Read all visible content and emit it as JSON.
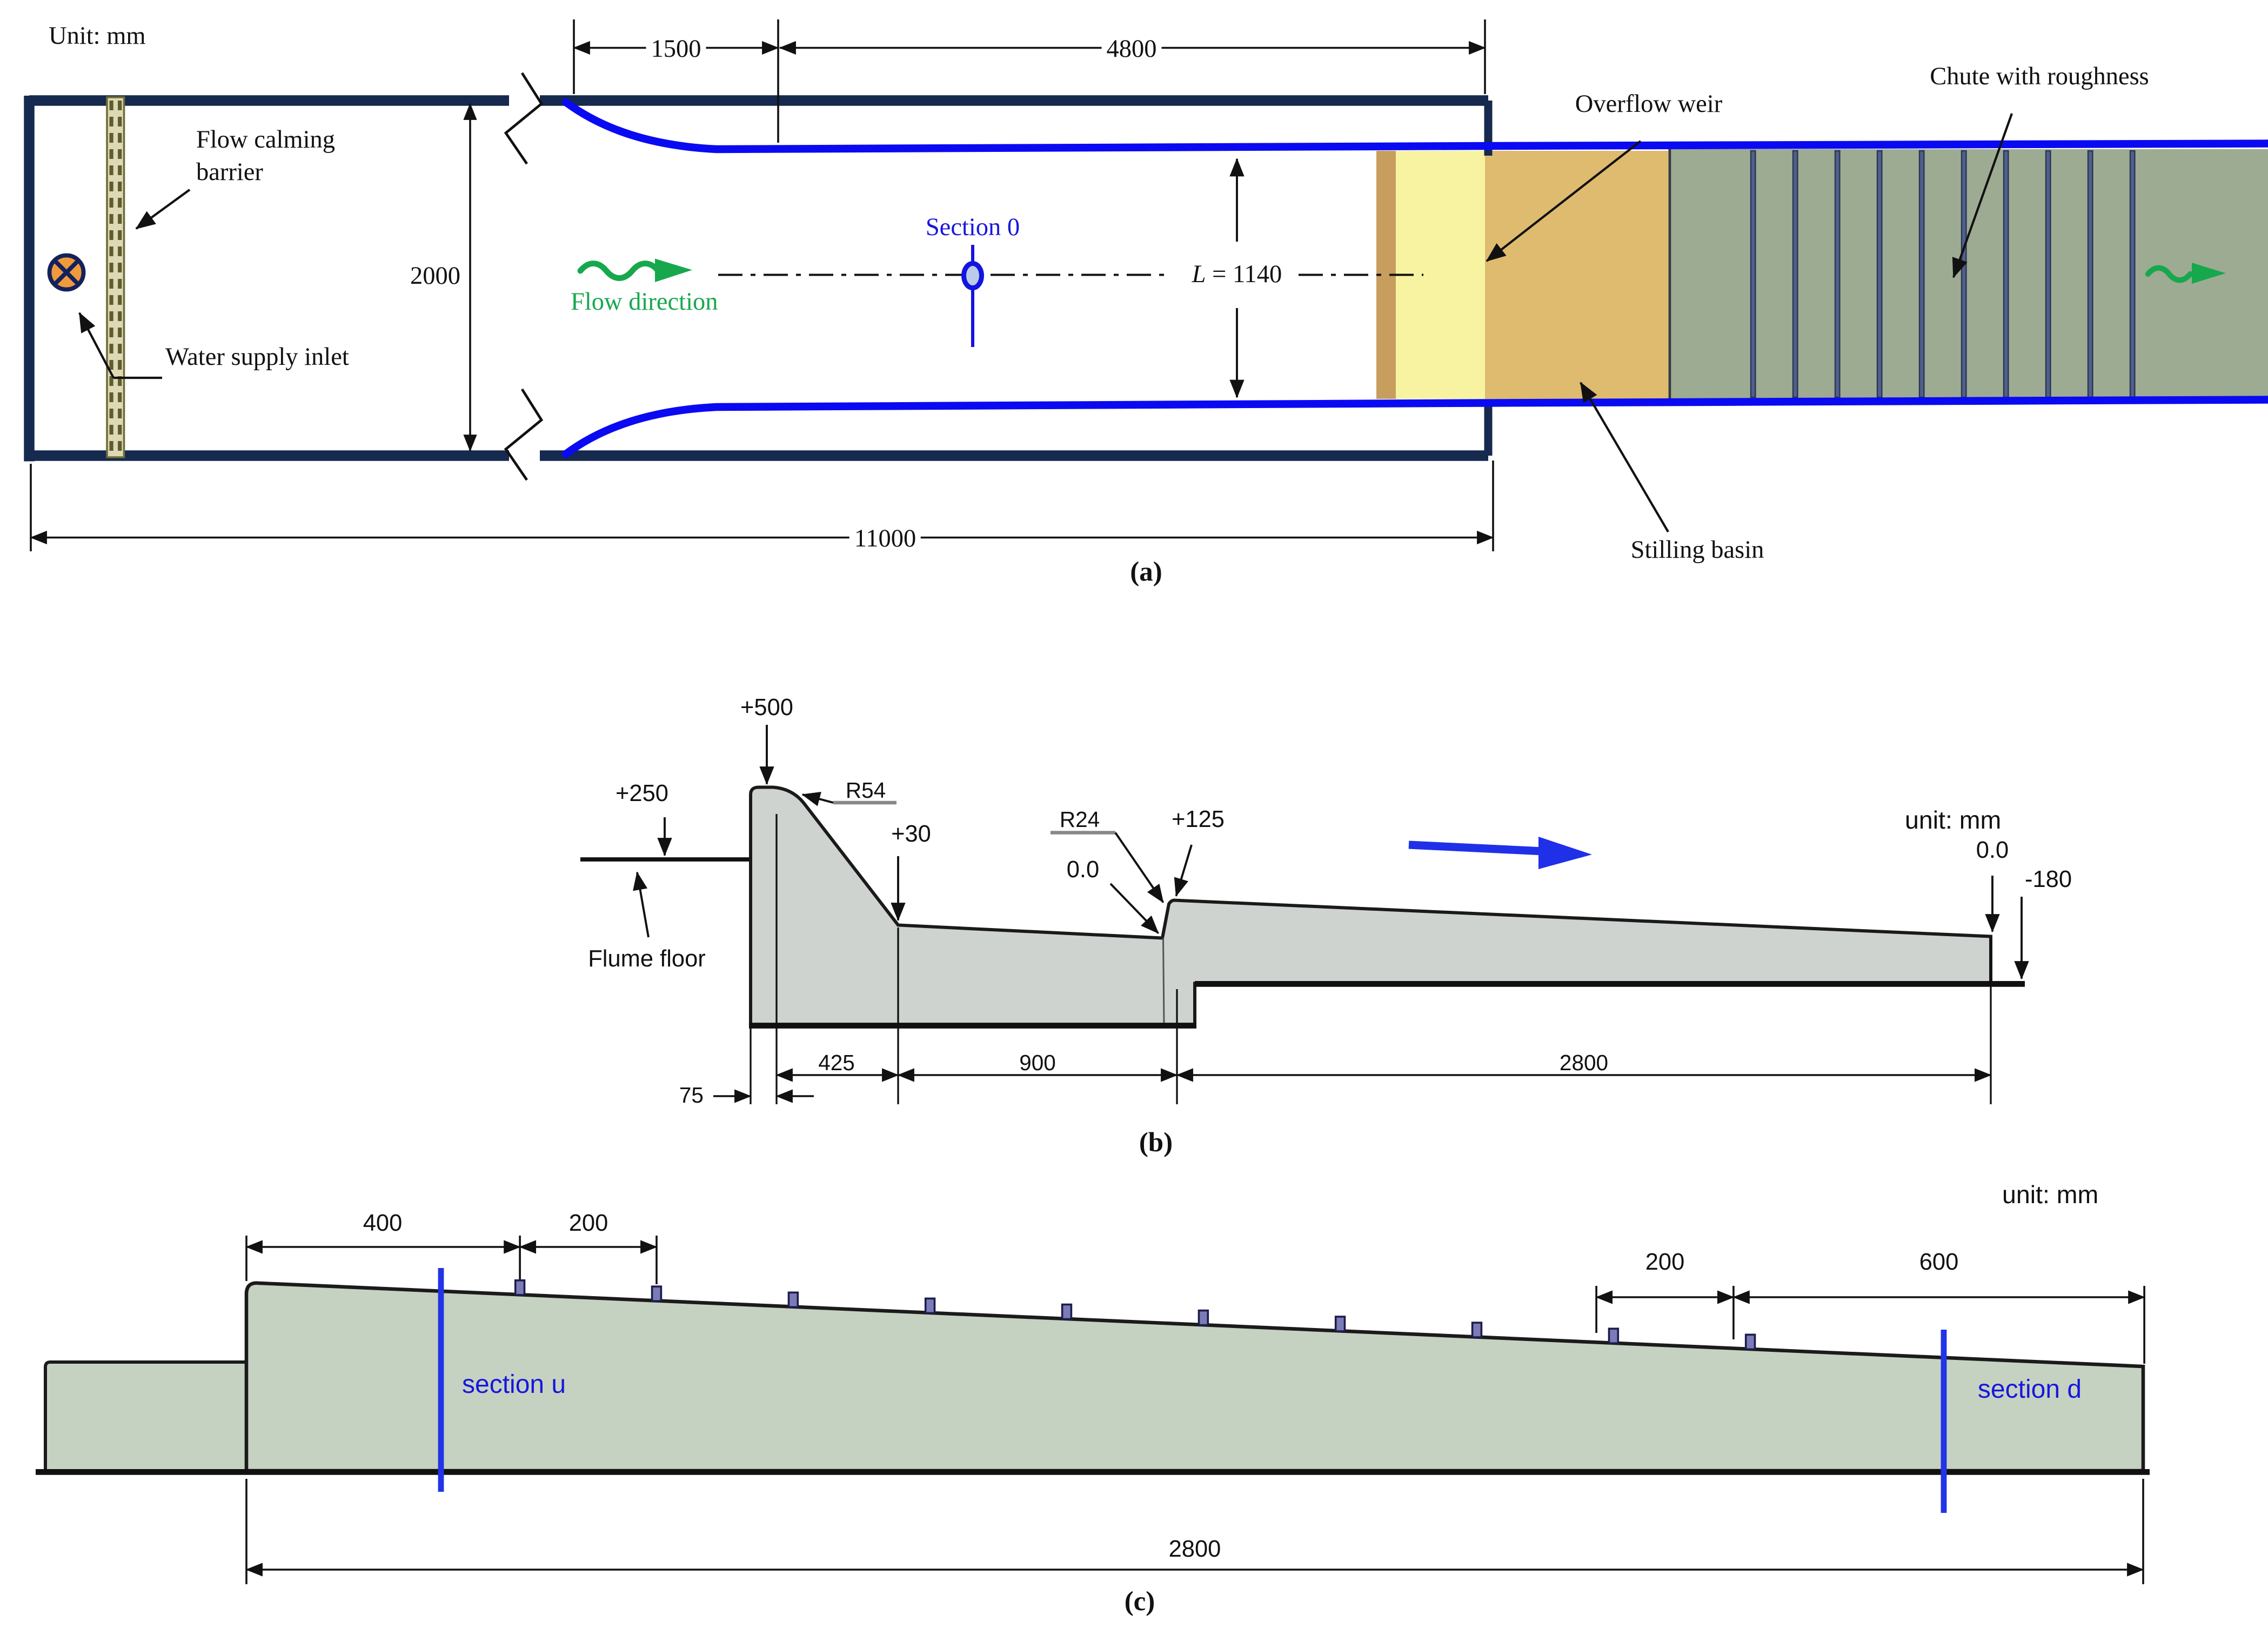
{
  "panel_a": {
    "unit_label": "Unit: mm",
    "labels": {
      "flow_calming_barrier": "Flow calming barrier",
      "water_supply_inlet": "Water supply inlet",
      "flow_direction": "Flow direction",
      "section_0": "Section 0",
      "overflow_weir": "Overflow weir",
      "chute_with_roughness": "Chute with roughness",
      "stilling_basin": "Stilling basin"
    },
    "dimensions": {
      "contraction_length": "1500",
      "approach_length": "4800",
      "flume_width": "2000",
      "total_length": "11000",
      "channel_width_prefix": "L",
      "channel_width_rest": " = 1140"
    },
    "caption": "(a)"
  },
  "panel_b": {
    "unit_label": "unit: mm",
    "elevations": {
      "crest": "+500",
      "flume_floor_level": "+250",
      "crest_radius": "R54",
      "toe": "+30",
      "step_radius": "R24",
      "basin_datum": "0.0",
      "chute_start": "+125",
      "outlet_datum": "0.0",
      "outlet_drop": "-180"
    },
    "labels": {
      "flume_floor": "Flume floor"
    },
    "dimensions": {
      "crest_offset": "75",
      "weir_slope_run": "425",
      "basin_length": "900",
      "chute_length": "2800"
    },
    "caption": "(b)"
  },
  "panel_c": {
    "unit_label": "unit: mm",
    "dimensions": {
      "first_block_offset": "400",
      "block_spacing_left": "200",
      "block_spacing_right": "200",
      "end_offset": "600",
      "chute_length": "2800"
    },
    "labels": {
      "section_u": "section u",
      "section_d": "section d"
    },
    "caption": "(c)"
  },
  "colors": {
    "flume_wall_navy": "#16294e",
    "channel_wall_blue": "#0a0af2",
    "annotation_blue": "#2030e8",
    "flow_green": "#17a84e",
    "weir_yellow": "#f8f3a1",
    "weir_edge_tan": "#c79e5e",
    "stilling_basin_tan": "#debb6e",
    "chute_gray_green": "#9dab93",
    "roughness_bar_slate": "#50608c",
    "profile_gray": "#cfd3cf",
    "chute_side_sage": "#c6d2c1",
    "roughness_block_purple": "#7b7bb9",
    "inlet_orange": "#f09a3c"
  }
}
